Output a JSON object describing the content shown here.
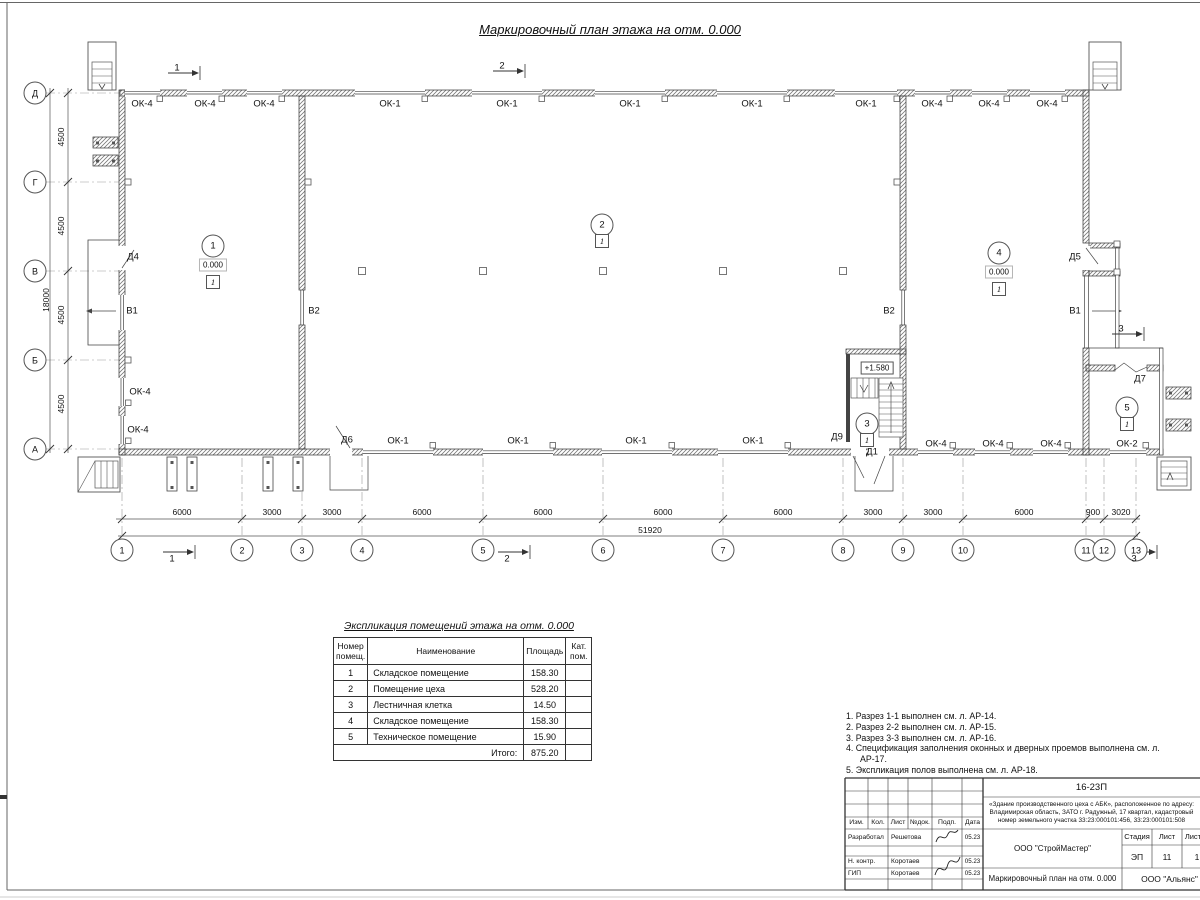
{
  "page": {
    "main_title": "Маркировочный план этажа на отм. 0.000"
  },
  "plan": {
    "axis_rows": [
      {
        "label": "Д",
        "y": 93
      },
      {
        "label": "Г",
        "y": 182
      },
      {
        "label": "В",
        "y": 271
      },
      {
        "label": "Б",
        "y": 360
      },
      {
        "label": "А",
        "y": 449
      }
    ],
    "axis_cols": [
      {
        "label": "1",
        "x": 122
      },
      {
        "label": "2",
        "x": 242
      },
      {
        "label": "3",
        "x": 302
      },
      {
        "label": "4",
        "x": 362
      },
      {
        "label": "5",
        "x": 483
      },
      {
        "label": "6",
        "x": 603
      },
      {
        "label": "7",
        "x": 723
      },
      {
        "label": "8",
        "x": 843
      },
      {
        "label": "9",
        "x": 903
      },
      {
        "label": "10",
        "x": 963
      },
      {
        "label": "11",
        "x": 1086
      },
      {
        "label": "12",
        "x": 1104
      },
      {
        "label": "13",
        "x": 1136
      }
    ],
    "dims_left": [
      {
        "text": "4500",
        "y": 137
      },
      {
        "text": "4500",
        "y": 226
      },
      {
        "text": "4500",
        "y": 315
      },
      {
        "text": "4500",
        "y": 404
      }
    ],
    "dim_left_total": {
      "text": "18000",
      "x": 46,
      "y": 300
    },
    "dims_bottom": [
      {
        "text": "6000",
        "x": 182
      },
      {
        "text": "3000",
        "x": 272
      },
      {
        "text": "3000",
        "x": 332
      },
      {
        "text": "6000",
        "x": 422
      },
      {
        "text": "6000",
        "x": 543
      },
      {
        "text": "6000",
        "x": 663
      },
      {
        "text": "6000",
        "x": 783
      },
      {
        "text": "3000",
        "x": 873
      },
      {
        "text": "3000",
        "x": 933
      },
      {
        "text": "6000",
        "x": 1024
      },
      {
        "text": "900",
        "x": 1093
      },
      {
        "text": "3020",
        "x": 1121
      }
    ],
    "dim_bottom_total": {
      "text": "51920",
      "x": 650,
      "y": 535
    },
    "wall_labels": [
      {
        "text": "ОК-4",
        "x": 142,
        "y": 104
      },
      {
        "text": "ОК-4",
        "x": 205,
        "y": 104
      },
      {
        "text": "ОК-4",
        "x": 264,
        "y": 104
      },
      {
        "text": "ОК-1",
        "x": 390,
        "y": 104
      },
      {
        "text": "ОК-1",
        "x": 507,
        "y": 104
      },
      {
        "text": "ОК-1",
        "x": 630,
        "y": 104
      },
      {
        "text": "ОК-1",
        "x": 752,
        "y": 104
      },
      {
        "text": "ОК-1",
        "x": 866,
        "y": 104
      },
      {
        "text": "ОК-4",
        "x": 932,
        "y": 104
      },
      {
        "text": "ОК-4",
        "x": 989,
        "y": 104
      },
      {
        "text": "ОК-4",
        "x": 1047,
        "y": 104
      },
      {
        "text": "Д4",
        "x": 133,
        "y": 257
      },
      {
        "text": "В1",
        "x": 132,
        "y": 311
      },
      {
        "text": "ОК-4",
        "x": 140,
        "y": 392
      },
      {
        "text": "ОК-4",
        "x": 138,
        "y": 430
      },
      {
        "text": "В2",
        "x": 314,
        "y": 311
      },
      {
        "text": "В2",
        "x": 889,
        "y": 311
      },
      {
        "text": "Д5",
        "x": 1075,
        "y": 257
      },
      {
        "text": "В1",
        "x": 1075,
        "y": 311
      },
      {
        "text": "Д7",
        "x": 1140,
        "y": 379
      },
      {
        "text": "Д6",
        "x": 347,
        "y": 440
      },
      {
        "text": "ОК-1",
        "x": 398,
        "y": 441
      },
      {
        "text": "ОК-1",
        "x": 518,
        "y": 441
      },
      {
        "text": "ОК-1",
        "x": 636,
        "y": 441
      },
      {
        "text": "ОК-1",
        "x": 753,
        "y": 441
      },
      {
        "text": "Д9",
        "x": 837,
        "y": 437
      },
      {
        "text": "Д1",
        "x": 872,
        "y": 452
      },
      {
        "text": "ОК-4",
        "x": 936,
        "y": 444
      },
      {
        "text": "ОК-4",
        "x": 993,
        "y": 444
      },
      {
        "text": "ОК-4",
        "x": 1051,
        "y": 444
      },
      {
        "text": "ОК-2",
        "x": 1127,
        "y": 444
      }
    ],
    "room_markers": [
      {
        "num": "1",
        "x": 213,
        "y": 246,
        "elev": "0.000",
        "floor": "1"
      },
      {
        "num": "2",
        "x": 602,
        "y": 225,
        "floor": "1"
      },
      {
        "num": "3",
        "x": 867,
        "y": 424,
        "floor": "1"
      },
      {
        "num": "4",
        "x": 999,
        "y": 253,
        "elev": "0.000",
        "floor": "1"
      },
      {
        "num": "5",
        "x": 1127,
        "y": 408,
        "floor": "1"
      }
    ],
    "stair_elevation": {
      "text": "+1.580",
      "x": 877,
      "y": 368
    },
    "section_marks": [
      {
        "n": "1",
        "x": 177,
        "y": 68
      },
      {
        "n": "2",
        "x": 502,
        "y": 66
      },
      {
        "n": "1",
        "x": 172,
        "y": 559
      },
      {
        "n": "2",
        "x": 507,
        "y": 559
      },
      {
        "n": "3",
        "x": 1134,
        "y": 559
      },
      {
        "n": "3",
        "x": 1121,
        "y": 329
      }
    ]
  },
  "legend_table": {
    "title": "Экспликация помещений этажа на отм. 0.000",
    "headers": [
      "Номер помещ.",
      "Наименование",
      "Площадь",
      "Кат. пом."
    ],
    "rows": [
      [
        "1",
        "Складское помещение",
        "158.30",
        ""
      ],
      [
        "2",
        "Помещение цеха",
        "528.20",
        ""
      ],
      [
        "3",
        "Лестничная клетка",
        "14.50",
        ""
      ],
      [
        "4",
        "Складское помещение",
        "158.30",
        ""
      ],
      [
        "5",
        "Техническое помещение",
        "15.90",
        ""
      ]
    ],
    "total_label": "Итого:",
    "total_value": "875.20"
  },
  "notes": [
    "1. Разрез 1-1 выполнен см. л. АР-14.",
    "2. Разрез 2-2 выполнен см. л. АР-15.",
    "3. Разрез 3-3 выполнен см. л. АР-16.",
    "4. Спецификация заполнения оконных и дверных проемов выполнена см. л. АР-17.",
    "5. Экспликация полов выполнена см. л. АР-18."
  ],
  "title_block": {
    "code": "16-23П",
    "project": "«Здание производственного цеха с АБК», расположенное по адресу: Владимирская область, ЗАТО г. Радужный, 17 квартал, кадастровый номер земельного участка 33:23:000101:456, 33:23:000101:508",
    "cols": [
      "Изм.",
      "Кол.",
      "Лист",
      "№док.",
      "Подп.",
      "Дата"
    ],
    "sig_rows": [
      {
        "role": "Разработал",
        "name": "Решетова",
        "date": "05.23"
      },
      {
        "role": "Н. контр.",
        "name": "Коротаев",
        "date": "05.23"
      },
      {
        "role": "ГИП",
        "name": "Коротаев",
        "date": "05.23"
      }
    ],
    "org": "ООО \"СтройМастер\"",
    "stage_label": "Стадия",
    "sheet_label": "Лист",
    "sheets_label": "Листов",
    "stage": "ЭП",
    "sheet": "11",
    "sheets": "1",
    "drawing_title": "Маркировочный план на отм. 0.000",
    "org2": "ООО \"Альянс\""
  }
}
